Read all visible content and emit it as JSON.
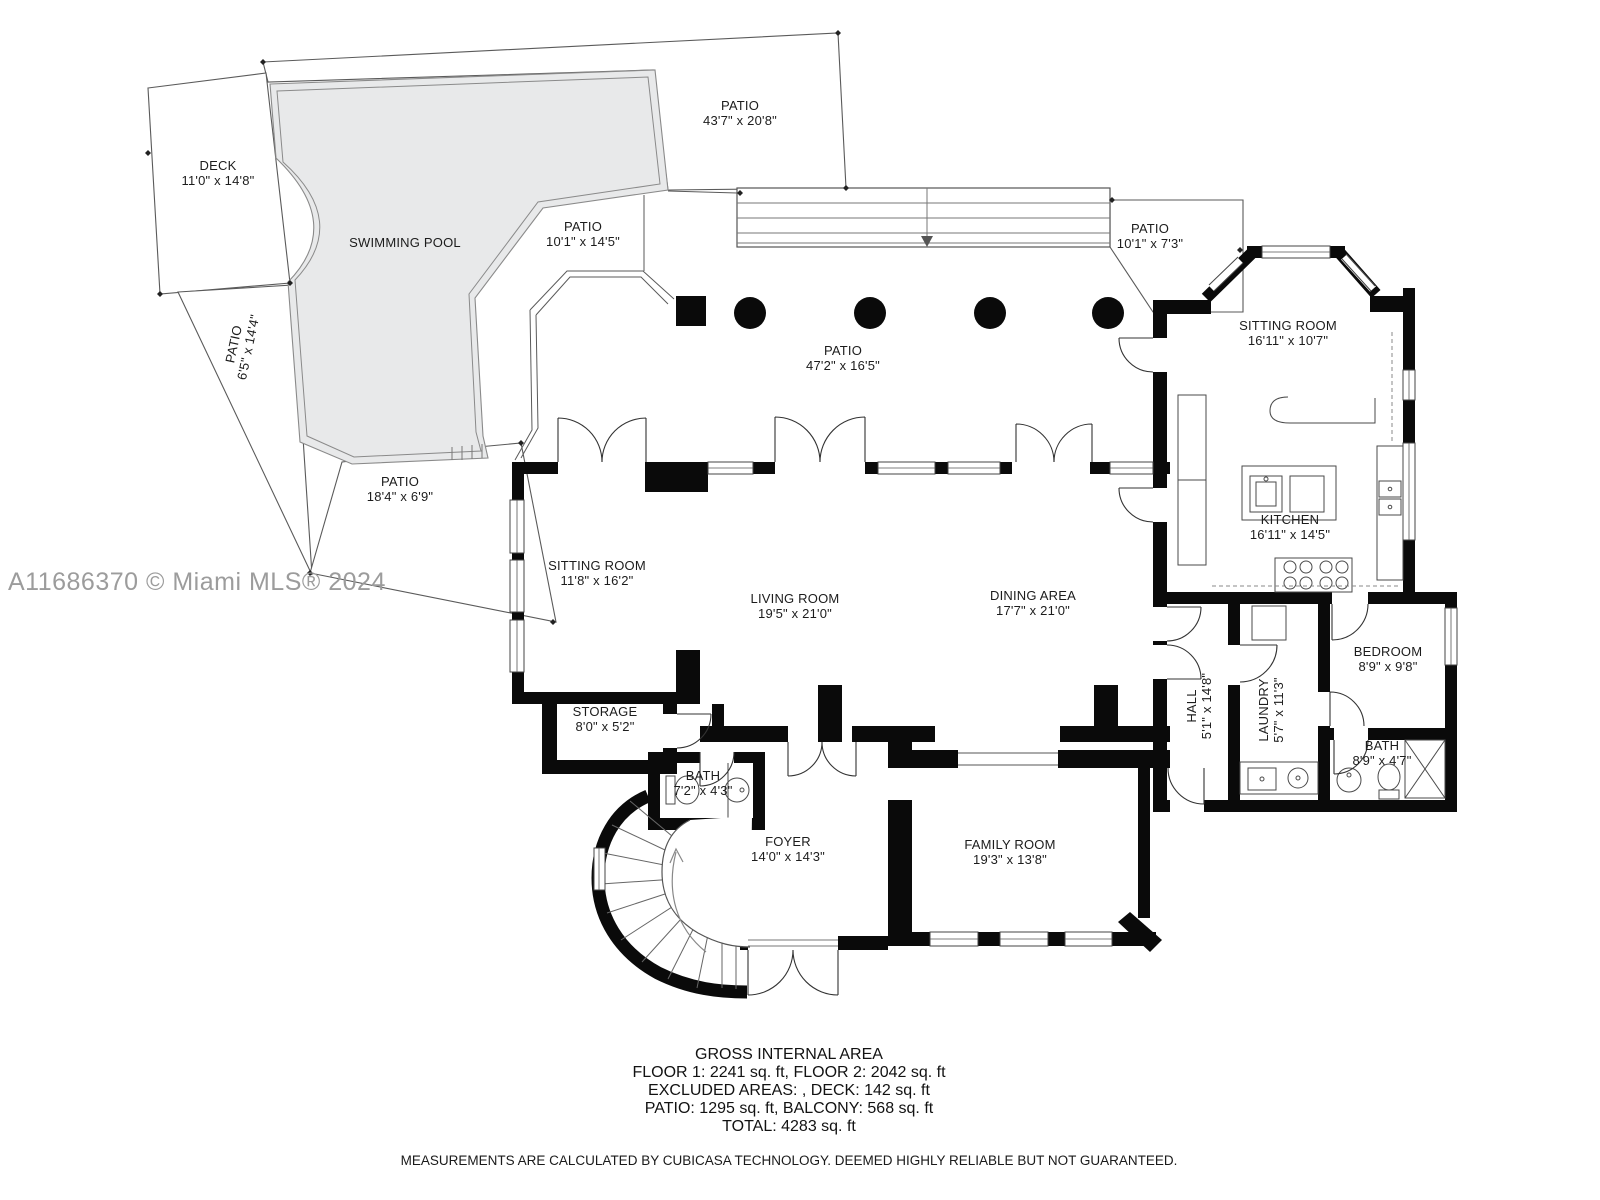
{
  "watermark": "A11686370 © Miami MLS® 2024",
  "colors": {
    "wall": "#0a0a0a",
    "pool_fill": "#e8e9ea",
    "outline": "#5a5a5a",
    "watermark": "#9c9c9c"
  },
  "rooms": {
    "patio_top": {
      "name": "PATIO",
      "dims": "43'7\" x 20'8\""
    },
    "deck": {
      "name": "DECK",
      "dims": "11'0\" x 14'8\""
    },
    "pool": {
      "name": "SWIMMING POOL"
    },
    "patio_pool": {
      "name": "PATIO",
      "dims": "10'1\" x 14'5\""
    },
    "patio_left": {
      "name": "PATIO",
      "dims": "6'5\" x 14'4\""
    },
    "patio_bottom": {
      "name": "PATIO",
      "dims": "18'4\" x 6'9\""
    },
    "patio_main": {
      "name": "PATIO",
      "dims": "47'2\" x 16'5\""
    },
    "patio_right": {
      "name": "PATIO",
      "dims": "10'1\" x 7'3\""
    },
    "sitting_right": {
      "name": "SITTING ROOM",
      "dims": "16'11\" x 10'7\""
    },
    "kitchen": {
      "name": "KITCHEN",
      "dims": "16'11\" x 14'5\""
    },
    "sitting_left": {
      "name": "SITTING ROOM",
      "dims": "11'8\" x 16'2\""
    },
    "living": {
      "name": "LIVING ROOM",
      "dims": "19'5\" x 21'0\""
    },
    "dining": {
      "name": "DINING AREA",
      "dims": "17'7\" x 21'0\""
    },
    "bedroom": {
      "name": "BEDROOM",
      "dims": "8'9\" x 9'8\""
    },
    "hall": {
      "name": "HALL",
      "dims": "5'1\" x 14'8\""
    },
    "laundry": {
      "name": "LAUNDRY",
      "dims": "5'7\" x 11'3\""
    },
    "bath_hall": {
      "name": "BATH",
      "dims": "8'9\" x 4'7\""
    },
    "storage": {
      "name": "STORAGE",
      "dims": "8'0\" x 5'2\""
    },
    "bath_foyer": {
      "name": "BATH",
      "dims": "7'2\" x 4'3\""
    },
    "foyer": {
      "name": "FOYER",
      "dims": "14'0\" x 14'3\""
    },
    "family": {
      "name": "FAMILY ROOM",
      "dims": "19'3\" x 13'8\""
    }
  },
  "footer": {
    "title": "GROSS INTERNAL AREA",
    "line1": "FLOOR 1: 2241 sq. ft, FLOOR 2: 2042 sq. ft",
    "line2": "EXCLUDED AREAS: , DECK: 142 sq. ft",
    "line3": "PATIO: 1295 sq. ft, BALCONY: 568 sq. ft",
    "total": "TOTAL: 4283 sq. ft",
    "disclaimer": "MEASUREMENTS ARE CALCULATED BY CUBICASA TECHNOLOGY. DEEMED HIGHLY RELIABLE BUT NOT GUARANTEED."
  }
}
